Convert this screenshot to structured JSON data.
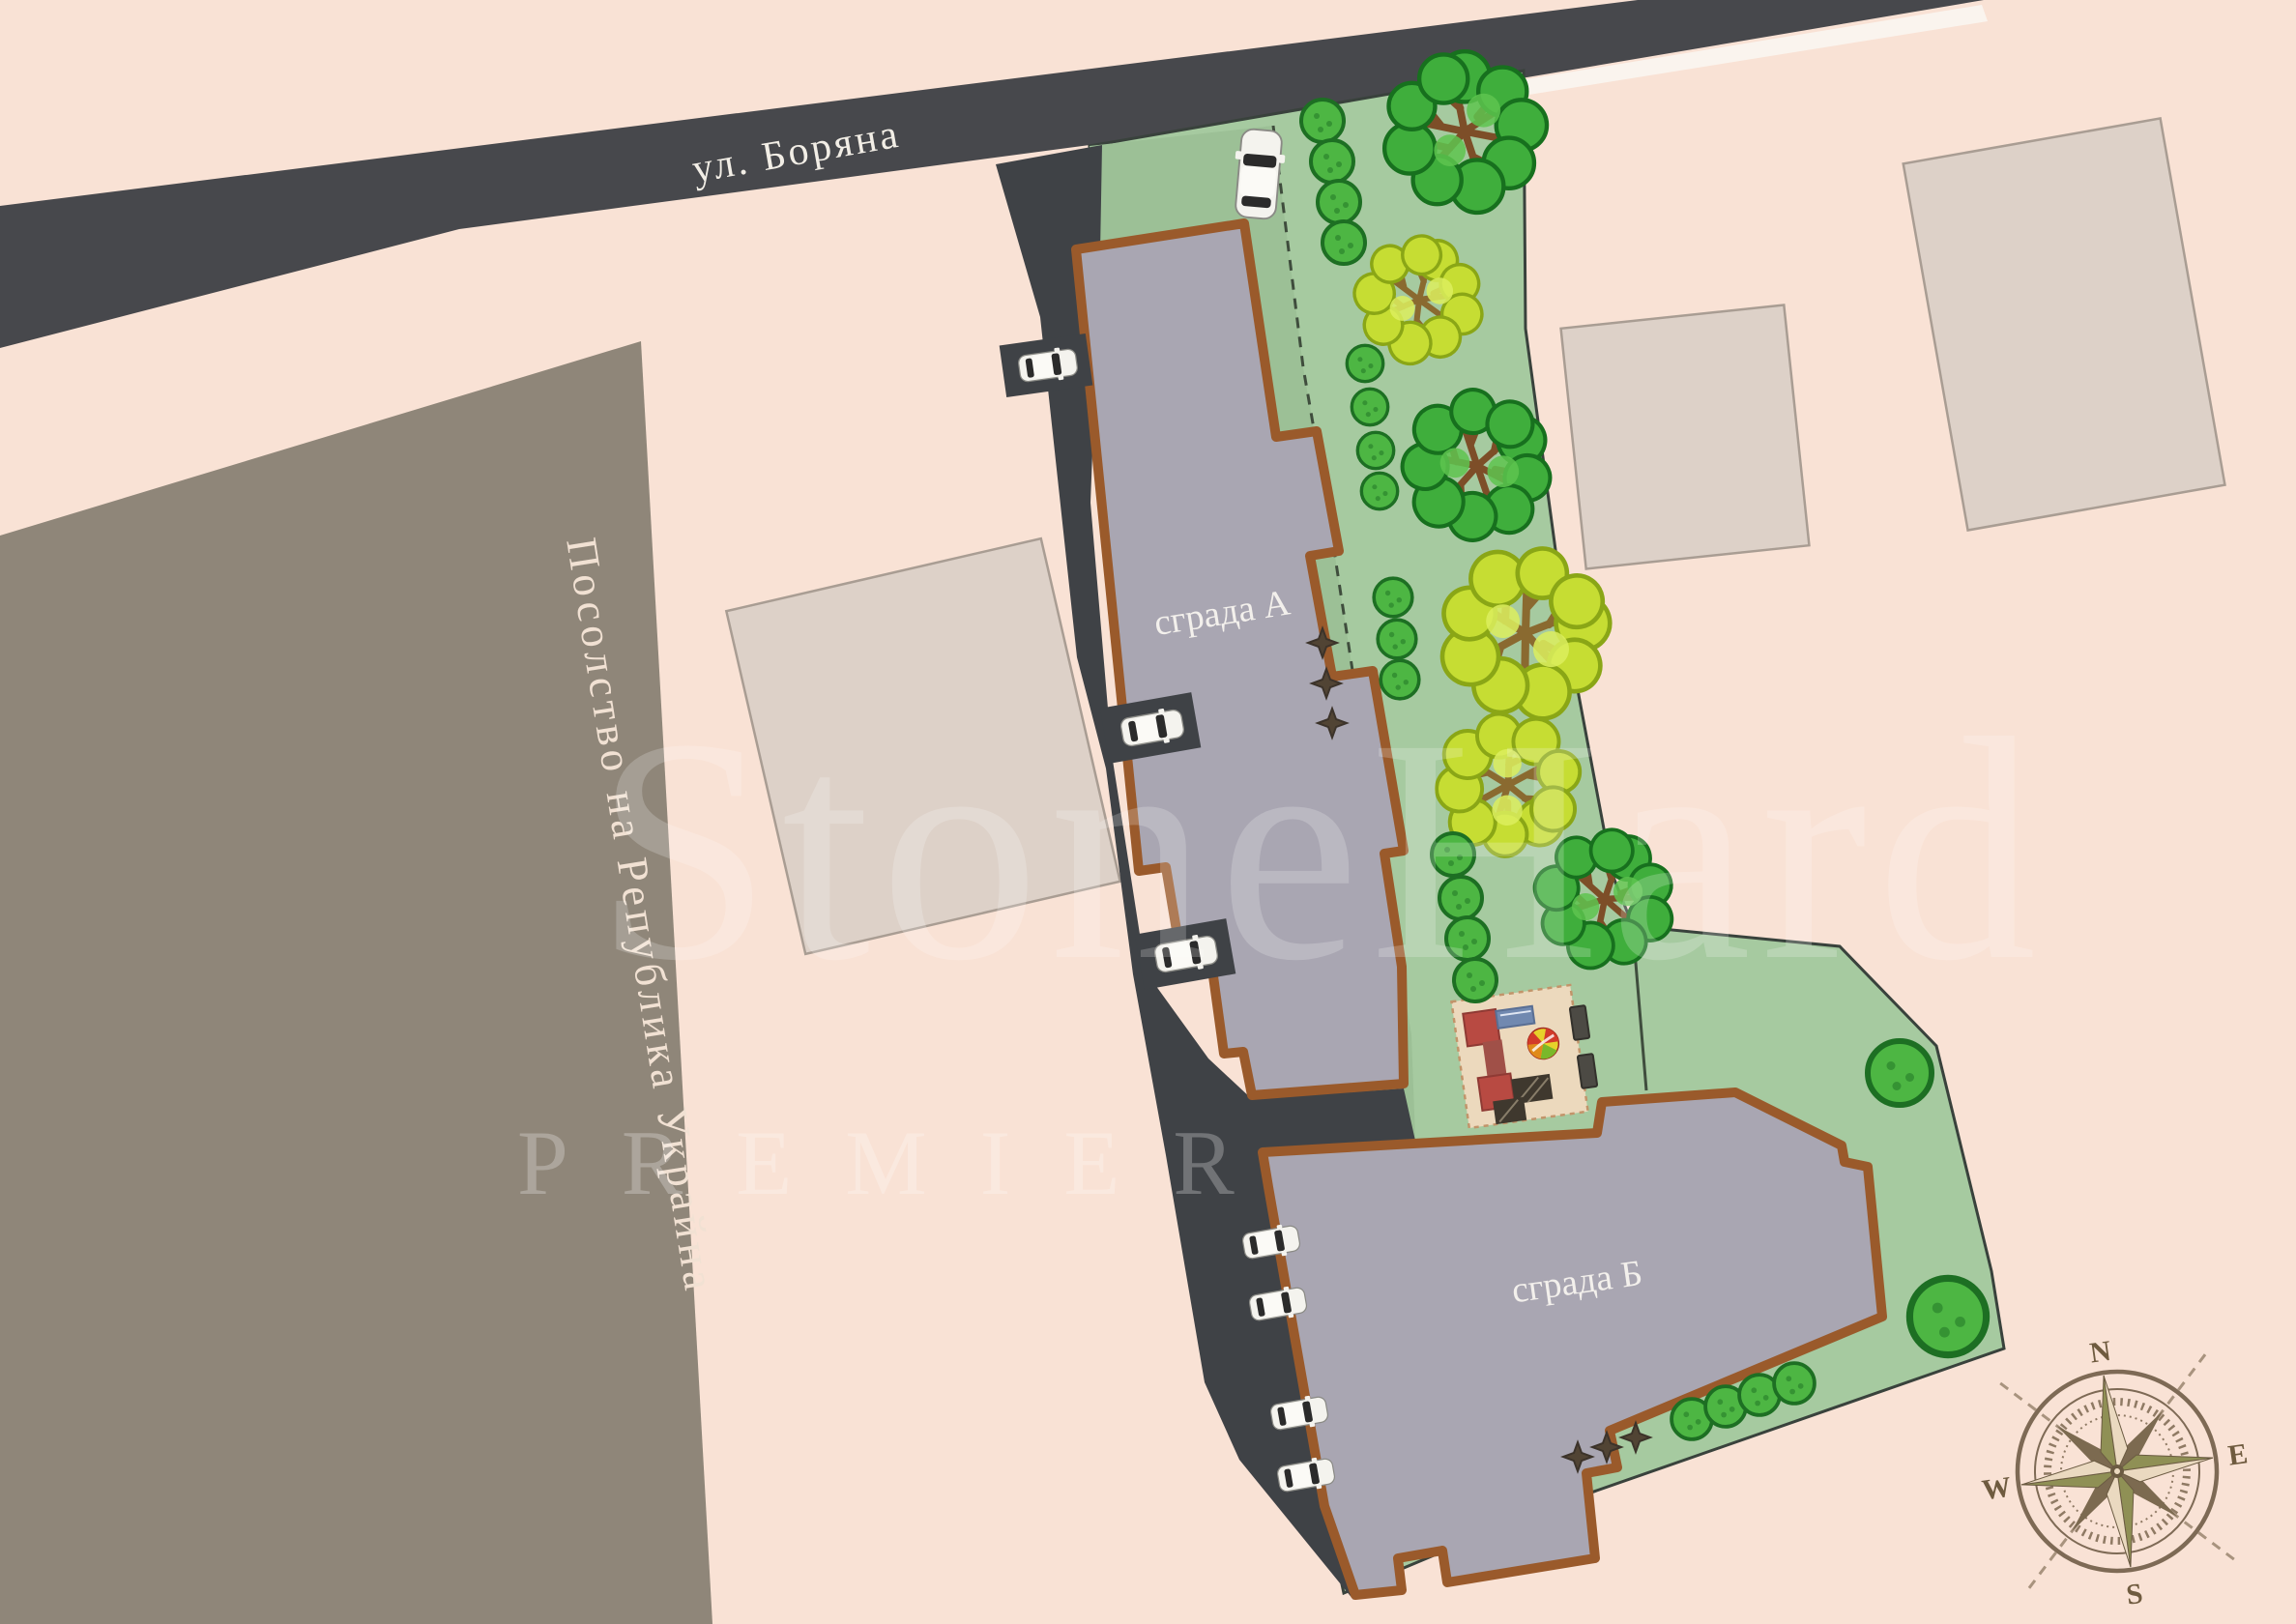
{
  "street": {
    "label": "ул. Боряна"
  },
  "embassy": {
    "label": "Посолство на Република Украйна"
  },
  "buildings": {
    "a": {
      "label": "сграда А"
    },
    "b": {
      "label": "сграда Б"
    }
  },
  "compass": {
    "n": "N",
    "e": "E",
    "s": "S",
    "w": "W"
  },
  "watermark": {
    "line1": "StoneHard",
    "line2": "PREMIER"
  },
  "colors": {
    "background": "#f9e2d5",
    "road": "#47484c",
    "driveway": "#3f4246",
    "road_edge": "#faf4ee",
    "embassy": "#8f8679",
    "neighbor": "#ddd1c8",
    "parcel_green": "#a6caa0",
    "strip_green": "#9cc096",
    "building_fill": "#a9a6b2",
    "building_border": "#9a5a2b",
    "playground_sand": "#ecd9bd",
    "tree_green": "#3fae3c",
    "tree_yellow": "#c6dd33",
    "compass_brown": "#7e6a55"
  }
}
